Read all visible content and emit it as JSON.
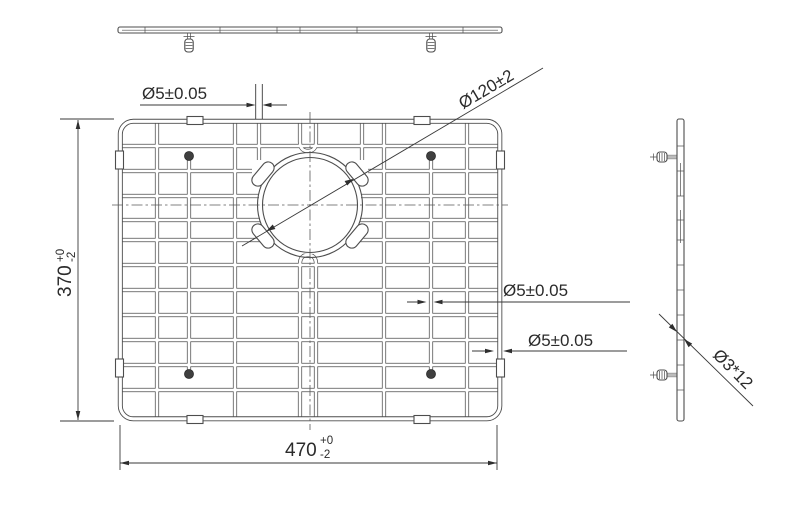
{
  "drawing": {
    "type": "engineering-drawing",
    "subject": "sink bottom grid with drain hole, three orthographic views",
    "colors": {
      "background": "#ffffff",
      "line": "#4d4d4d",
      "dimension": "#3a3a3a",
      "text": "#2b2b2b"
    },
    "views": {
      "top_profile": "front profile of grid with two feet",
      "plan": "plan view of wire grid with drain opening",
      "side_profile": "side profile of grid with two feet"
    },
    "dimensions": {
      "wire_diameter_top": {
        "label": "Ø5±0.05"
      },
      "hole_diameter": {
        "label": "Ø120±2"
      },
      "wire_diameter_right": {
        "label": "Ø5±0.05"
      },
      "frame_wire_diameter": {
        "label": "Ø5±0.05"
      },
      "grid_depth": {
        "value": "370",
        "tolerance_upper": "+0",
        "tolerance_lower": "-2"
      },
      "grid_width": {
        "value": "470",
        "tolerance_upper": "+0",
        "tolerance_lower": "-2"
      },
      "foot_size": {
        "label": "Ø3*12"
      }
    }
  }
}
